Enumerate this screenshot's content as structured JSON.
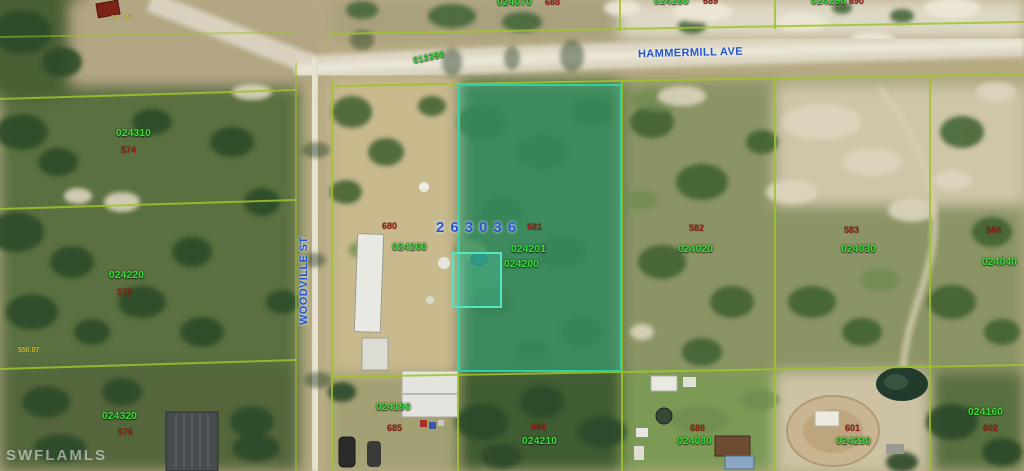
{
  "colors": {
    "parcel-line": "#9fc32b",
    "parcel-label": "#3bdc3b",
    "block-label": "#8f2418",
    "street-label": "#2156cc",
    "selected-label": "#2b55cf",
    "highlight": "#2fd0a6",
    "dimension-label": "#d8cb3a",
    "watermark": "#ffffff"
  },
  "map": {
    "watermark": "SWFLAMLS",
    "selected": {
      "id": "263036"
    },
    "streets": {
      "horizontal": "HAMMERMILL AVE",
      "vertical": "WOODVILLE ST"
    },
    "road_segment": "012350",
    "dimensions": [
      "324.97",
      "550.07"
    ],
    "parcels": [
      {
        "id": "024070",
        "block": "688"
      },
      {
        "id": "024280",
        "block": "689"
      },
      {
        "id": "024290",
        "block": "690"
      },
      {
        "id": "024310",
        "block": "574"
      },
      {
        "id": "024220",
        "block": "575"
      },
      {
        "id": "024320",
        "block": "576"
      },
      {
        "id": "024260",
        "block": "680"
      },
      {
        "id": "024201",
        "block": "581"
      },
      {
        "id": "024200",
        "block": ""
      },
      {
        "id": "024020",
        "block": "582"
      },
      {
        "id": "024030",
        "block": "583"
      },
      {
        "id": "024040",
        "block": "584"
      },
      {
        "id": "024190",
        "block": "685"
      },
      {
        "id": "024210",
        "block": "684"
      },
      {
        "id": "024080",
        "block": "686"
      },
      {
        "id": "024230",
        "block": "601"
      },
      {
        "id": "024160",
        "block": "602"
      }
    ]
  }
}
